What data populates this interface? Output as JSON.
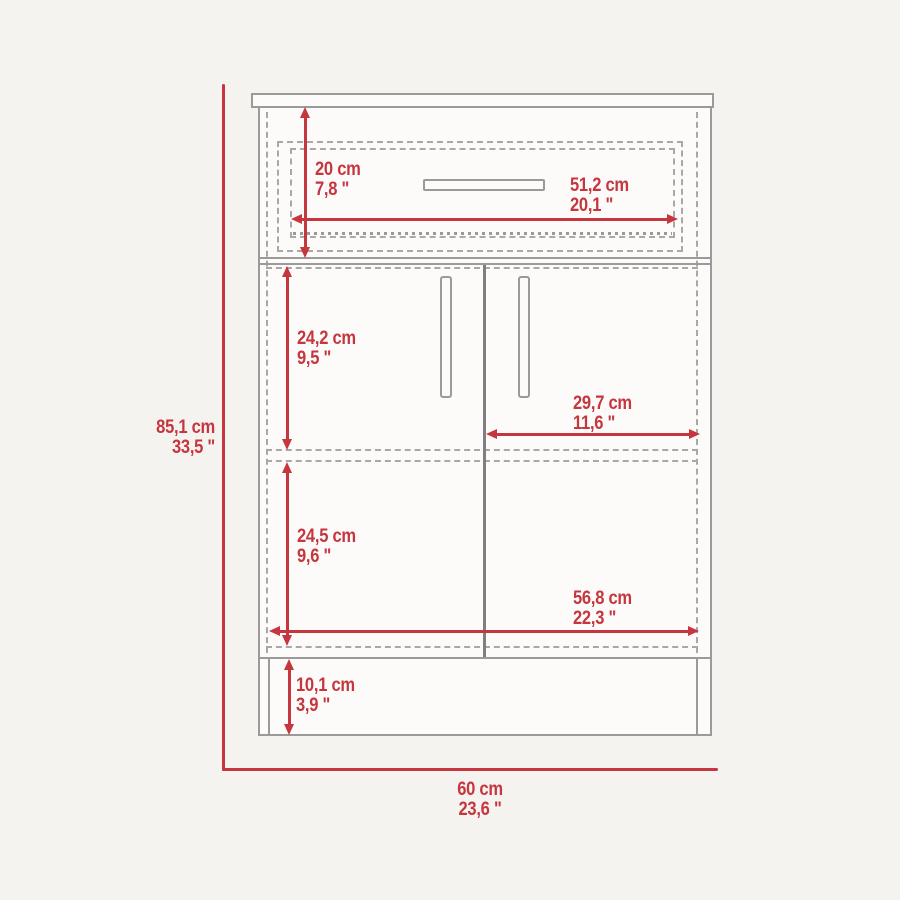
{
  "colors": {
    "dimension_red": "#c5363f",
    "outline_gray": "#9a9a9a",
    "background": "#f5f3f0"
  },
  "dimensions": {
    "overall_height": {
      "cm": "85,1 cm",
      "inch": "33,5 \""
    },
    "overall_width": {
      "cm": "60 cm",
      "inch": "23,6 \""
    },
    "drawer_height": {
      "cm": "20 cm",
      "inch": "7,8 \""
    },
    "drawer_width": {
      "cm": "51,2 cm",
      "inch": "20,1 \""
    },
    "upper_section_height": {
      "cm": "24,2 cm",
      "inch": "9,5 \""
    },
    "door_width": {
      "cm": "29,7 cm",
      "inch": "11,6 \""
    },
    "lower_section_height": {
      "cm": "24,5 cm",
      "inch": "9,6 \""
    },
    "interior_width": {
      "cm": "56,8 cm",
      "inch": "22,3 \""
    },
    "base_height": {
      "cm": "10,1 cm",
      "inch": "3,9 \""
    }
  }
}
